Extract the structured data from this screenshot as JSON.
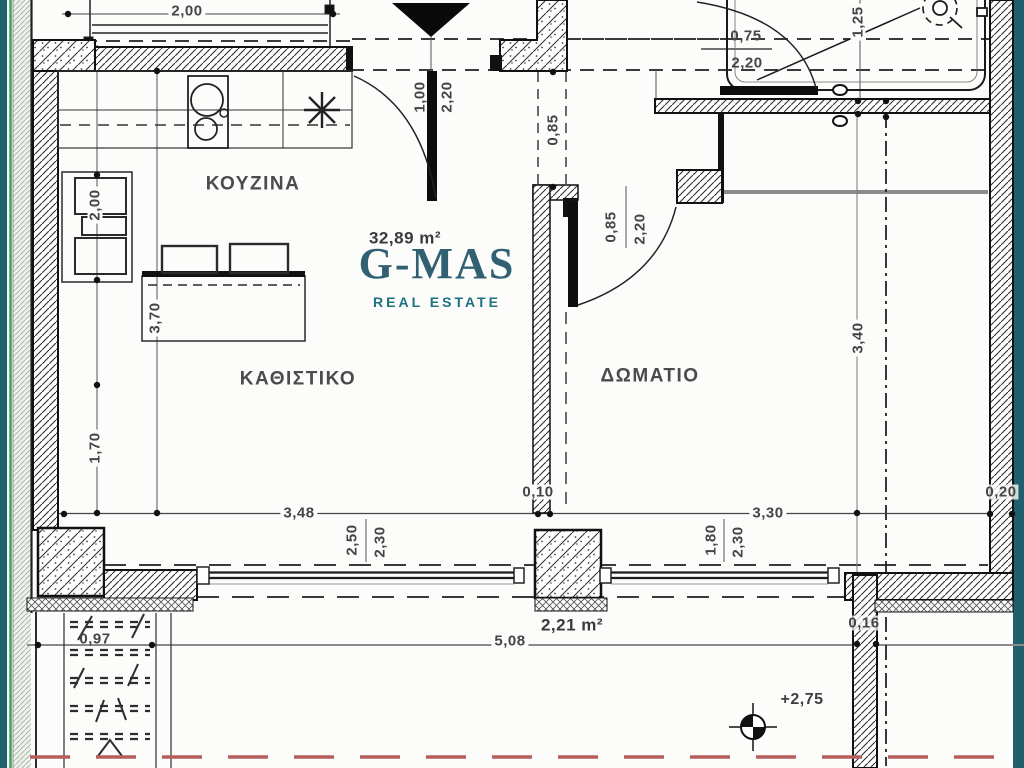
{
  "plan": {
    "rooms": {
      "kitchen": "ΚΟΥΖΙΝΑ",
      "living_room": "ΚΑΘΙΣΤΙΚΟ",
      "bedroom": "ΔΩΜΑΤΙΟ"
    },
    "areas": {
      "apartment": "32,89 m²",
      "balcony_pier": "2,21 m²"
    },
    "level_mark": "+2,75",
    "dimensions": {
      "top_window_width": "2,00",
      "kitchen_cabinet": "2,00",
      "kitchen_depth": "3,70",
      "living_left_wall": "1,70",
      "entry_door_width": "1,00",
      "entry_door_height": "2,20",
      "hall_opening": "0,85",
      "bedroom_door_width": "0,85",
      "bedroom_door_height": "2,20",
      "bath_door_width": "0,75",
      "bath_door_height": "2,20",
      "shower_width": "1,25",
      "bedroom_depth": "3,40",
      "right_wall_thickness": "0,20",
      "living_width": "3,48",
      "living_window_width": "2,50",
      "living_window_height": "2,30",
      "mid_wall_thickness": "0,10",
      "bedroom_width": "3,30",
      "bedroom_window_width": "1,80",
      "bedroom_window_height": "2,30",
      "balcony_length": "5,08",
      "pier_width": "0,16",
      "stair_width": "0,97"
    }
  },
  "watermark": {
    "title": "G-MAS",
    "subtitle": "REAL ESTATE"
  },
  "colors": {
    "logo_teal": "#316072",
    "logo_subtitle_teal": "#1f7080",
    "frame_teal": "#20606c",
    "survey_green": "#43a05e",
    "boundary_red": "#b45f5c"
  }
}
